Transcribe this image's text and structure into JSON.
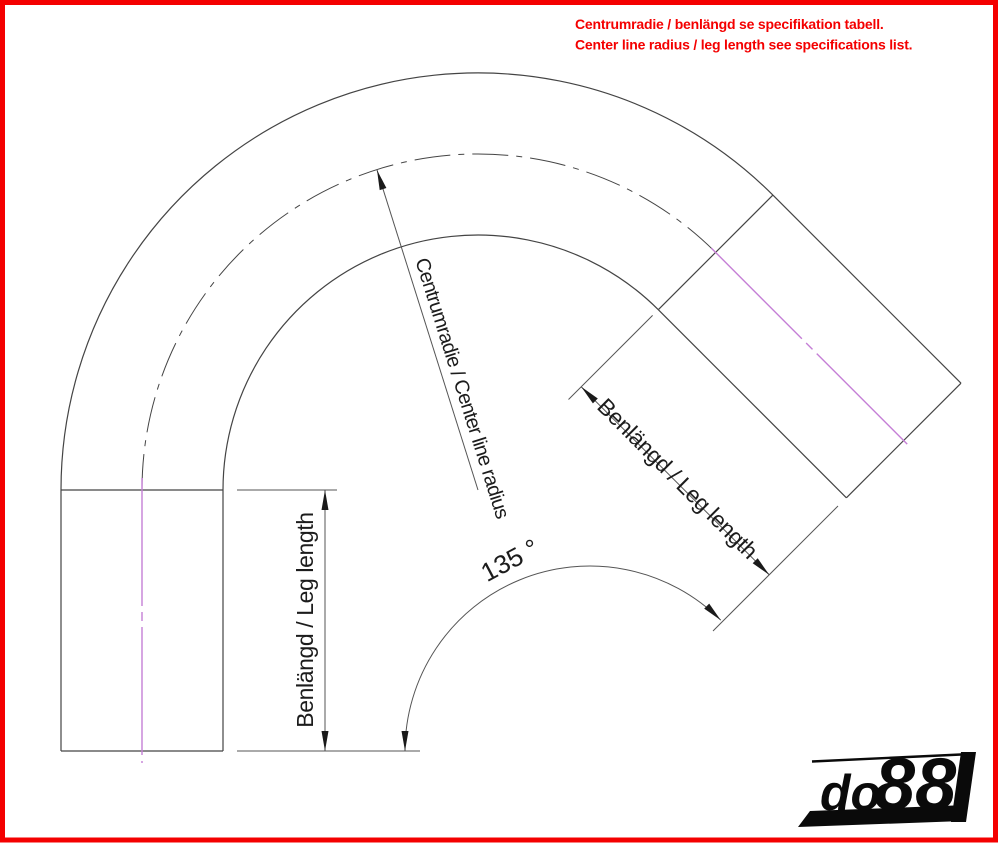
{
  "note": {
    "line1": "Centrumradie / benlängd se specifikation tabell.",
    "line2": "Center line radius / leg length see specifications list."
  },
  "dimensions": {
    "center_radius_label": "Centrumradie / Center line radius",
    "left_leg_label": "Benlängd / Leg length",
    "right_leg_label": "Benlängd / Leg length",
    "bend_angle_label": "135 °"
  },
  "logo": {
    "prefix": "do",
    "digits": "88"
  },
  "colors": {
    "frame_red": "#f40000",
    "note_red": "#f40000",
    "centerline_magenta": "#c57fd6",
    "drawing_line": "#444444",
    "dimension_line": "#555555",
    "arrow_fill": "#1a1a1a",
    "logo_black": "#0a0a0a"
  }
}
